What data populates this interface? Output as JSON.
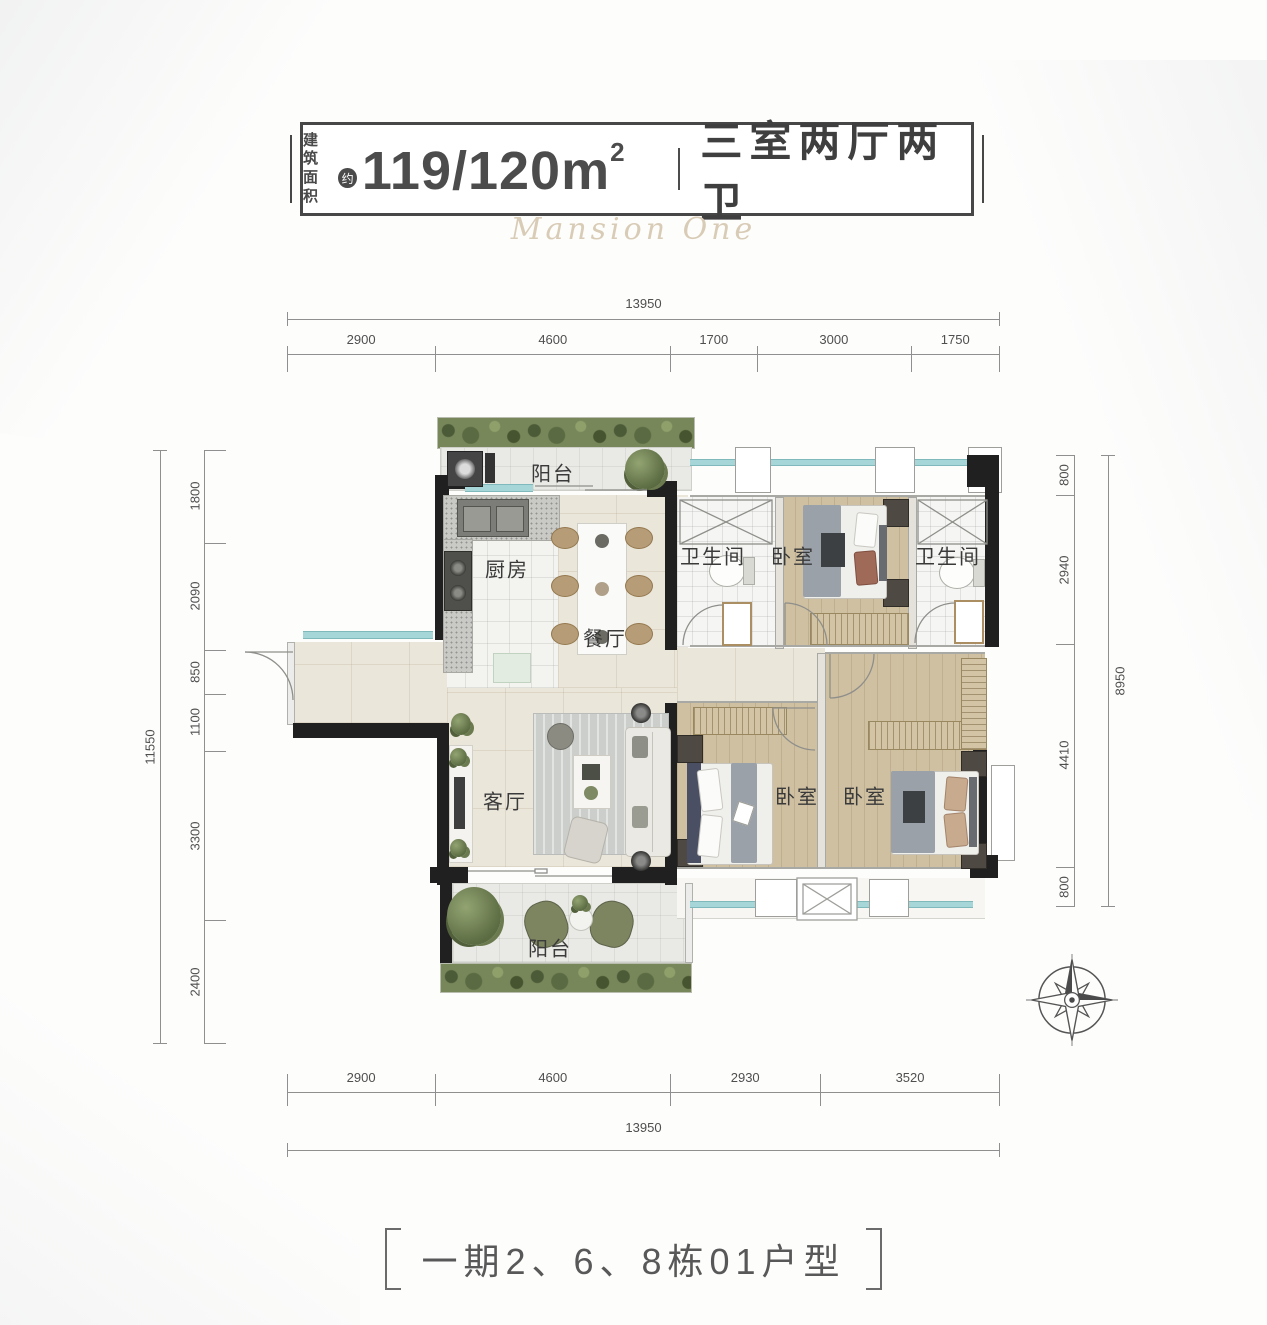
{
  "header": {
    "area_label_line1": "建筑",
    "area_label_line2": "面积",
    "approx": "约",
    "area_value": "119/120m",
    "area_sup": "2",
    "unit_type": "三室两厅两卫",
    "watermark": "Mansion One"
  },
  "rooms": {
    "balcony_top": "阳台",
    "kitchen": "厨房",
    "dining": "餐厅",
    "bathroom_1": "卫生间",
    "bedroom_top": "卧室",
    "bathroom_2": "卫生间",
    "living": "客厅",
    "bedroom_left": "卧室",
    "bedroom_right": "卧室",
    "balcony_bottom": "阳台"
  },
  "dimensions": {
    "top_total": "13950",
    "top_segments": [
      "2900",
      "4600",
      "1700",
      "3000",
      "1750"
    ],
    "bottom_segments": [
      "2900",
      "4600",
      "2930",
      "3520"
    ],
    "bottom_total": "13950",
    "left_total": "11550",
    "left_segments": [
      "1800",
      "2090",
      "850",
      "1100",
      "3300",
      "2400"
    ],
    "right_segments": [
      "800",
      "2940",
      "4410",
      "800"
    ],
    "right_total": "8950"
  },
  "footer": {
    "caption": "一期2、6、8栋01户型"
  },
  "colors": {
    "wall": "#202020",
    "wood_floor": "#cfc0a2",
    "cream_floor": "#ebe6da",
    "window": "#a6d6d8",
    "plant_green": "#6b7b4f",
    "text_dark": "#4a4a4a",
    "watermark_gold": "#d9ccb6"
  }
}
